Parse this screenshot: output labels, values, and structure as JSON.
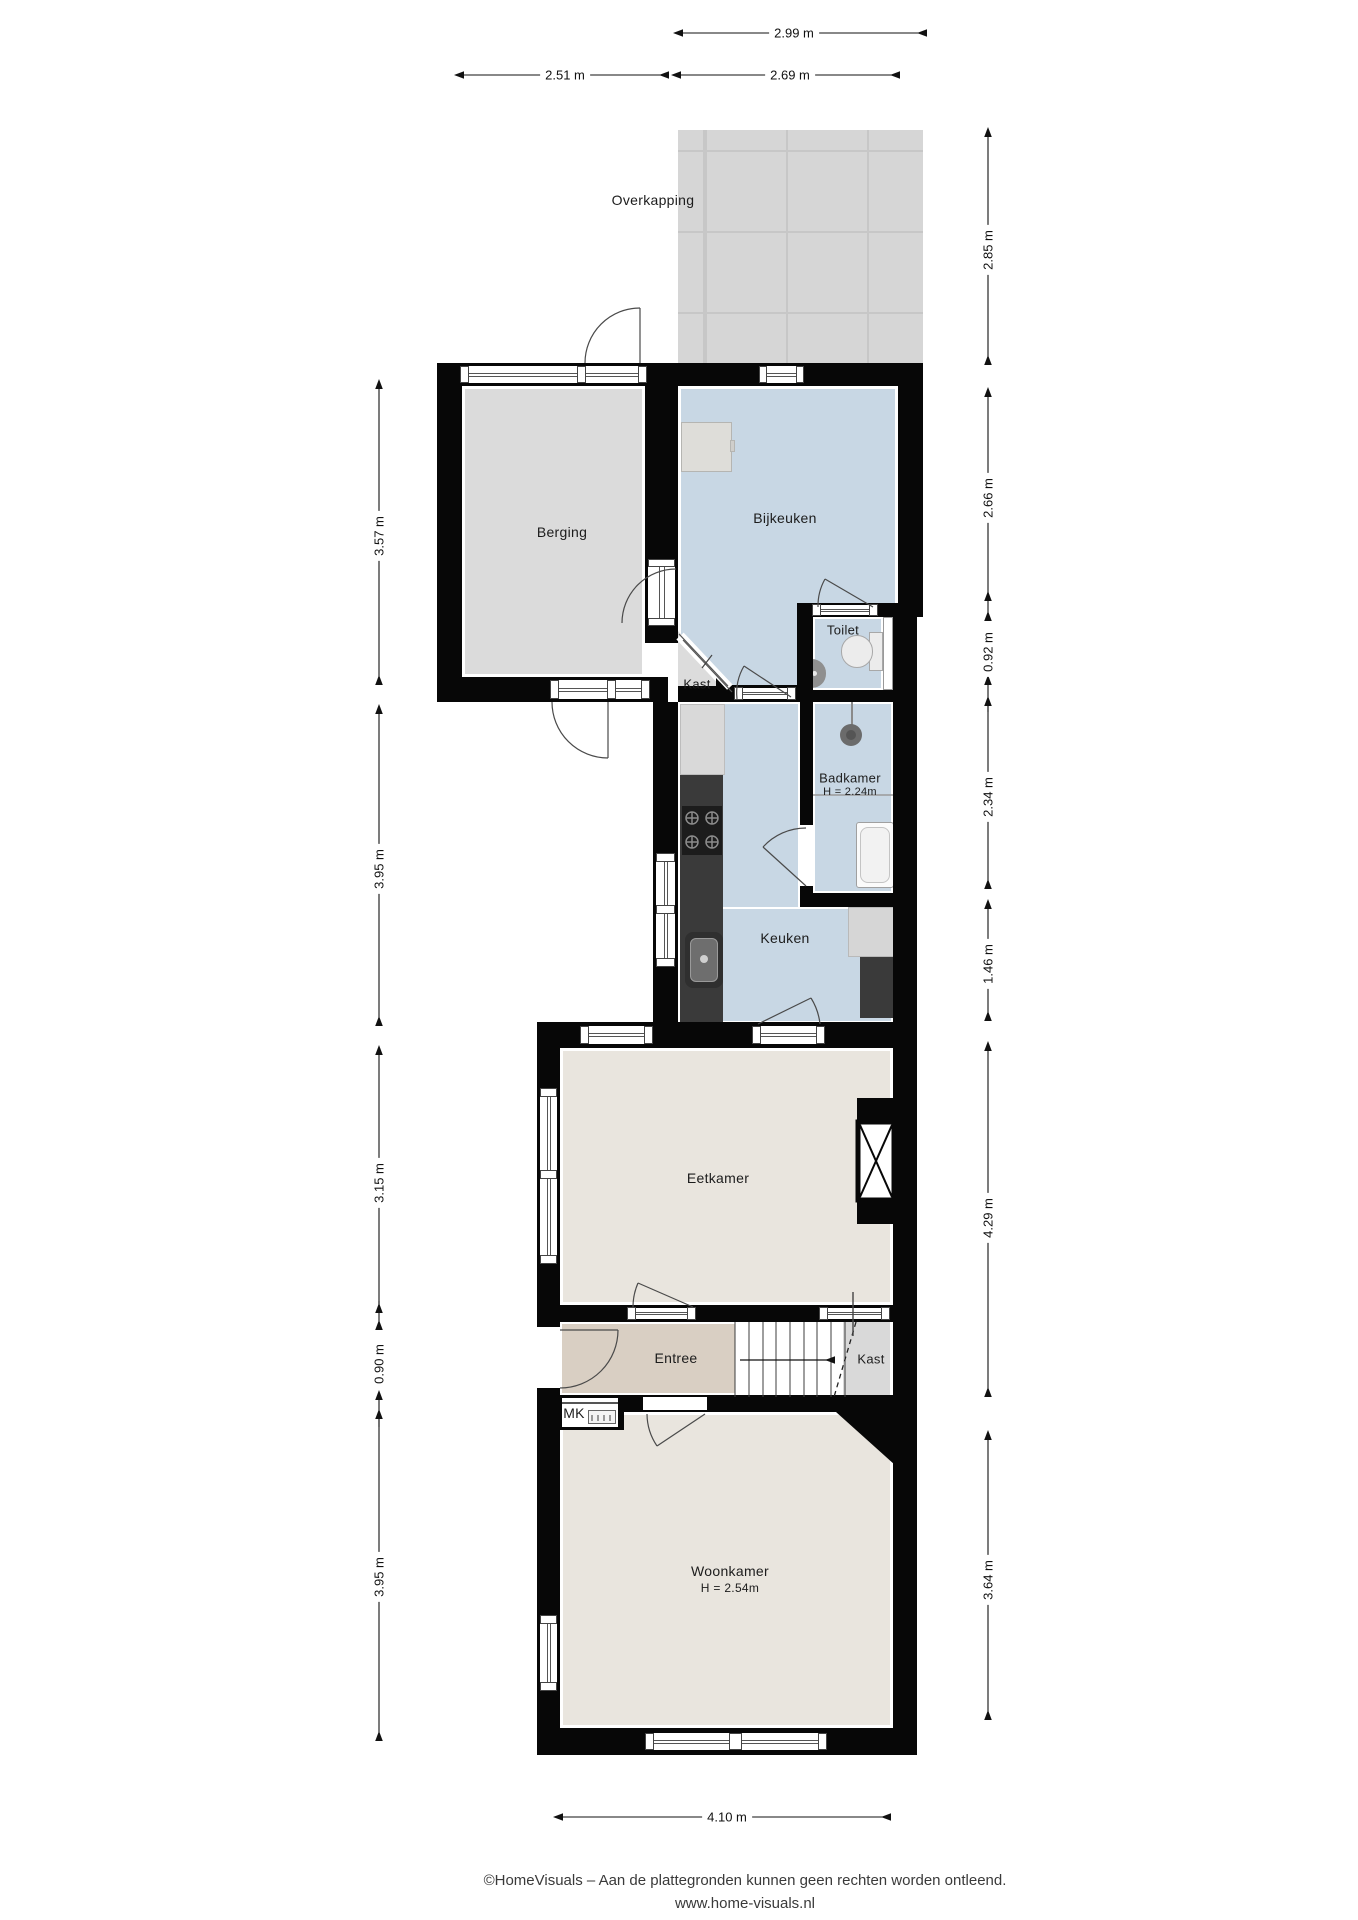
{
  "rooms": {
    "overkapping": "Overkapping",
    "berging": "Berging",
    "bijkeuken": "Bijkeuken",
    "toilet": "Toilet",
    "kast_bijkeuken": "Kast",
    "badkamer": "Badkamer",
    "badkamer_height": "H = 2.24m",
    "keuken": "Keuken",
    "eetkamer": "Eetkamer",
    "entree": "Entree",
    "kast_trap": "Kast",
    "mk": "MK",
    "woonkamer": "Woonkamer",
    "woonkamer_height": "H = 2.54m"
  },
  "dimensions": {
    "top_total": "2.99 m",
    "top_left": "2.51 m",
    "top_right": "2.69 m",
    "left_1": "3.57 m",
    "left_2": "3.95 m",
    "left_3": "3.15 m",
    "left_4": "0.90 m",
    "left_5": "3.95 m",
    "right_1": "2.85 m",
    "right_2": "2.66 m",
    "right_3": "0.92 m",
    "right_4": "2.34 m",
    "right_5": "1.46 m",
    "right_6": "4.29 m",
    "right_7": "3.64 m",
    "bottom": "4.10 m"
  },
  "footer": {
    "line1": "©HomeVisuals – Aan de plattegronden kunnen geen rechten worden ontleend.",
    "line2": "www.home-visuals.nl"
  },
  "colors": {
    "wall": "#070707",
    "wet_room_floor": "#c8d7e4",
    "living_floor": "#e9e5de",
    "entree_floor": "#d9cfc3",
    "storage_floor": "#dbdbdb",
    "overkapping_fill": "#d6d6d6",
    "counter_dark": "#3a3a3a"
  }
}
